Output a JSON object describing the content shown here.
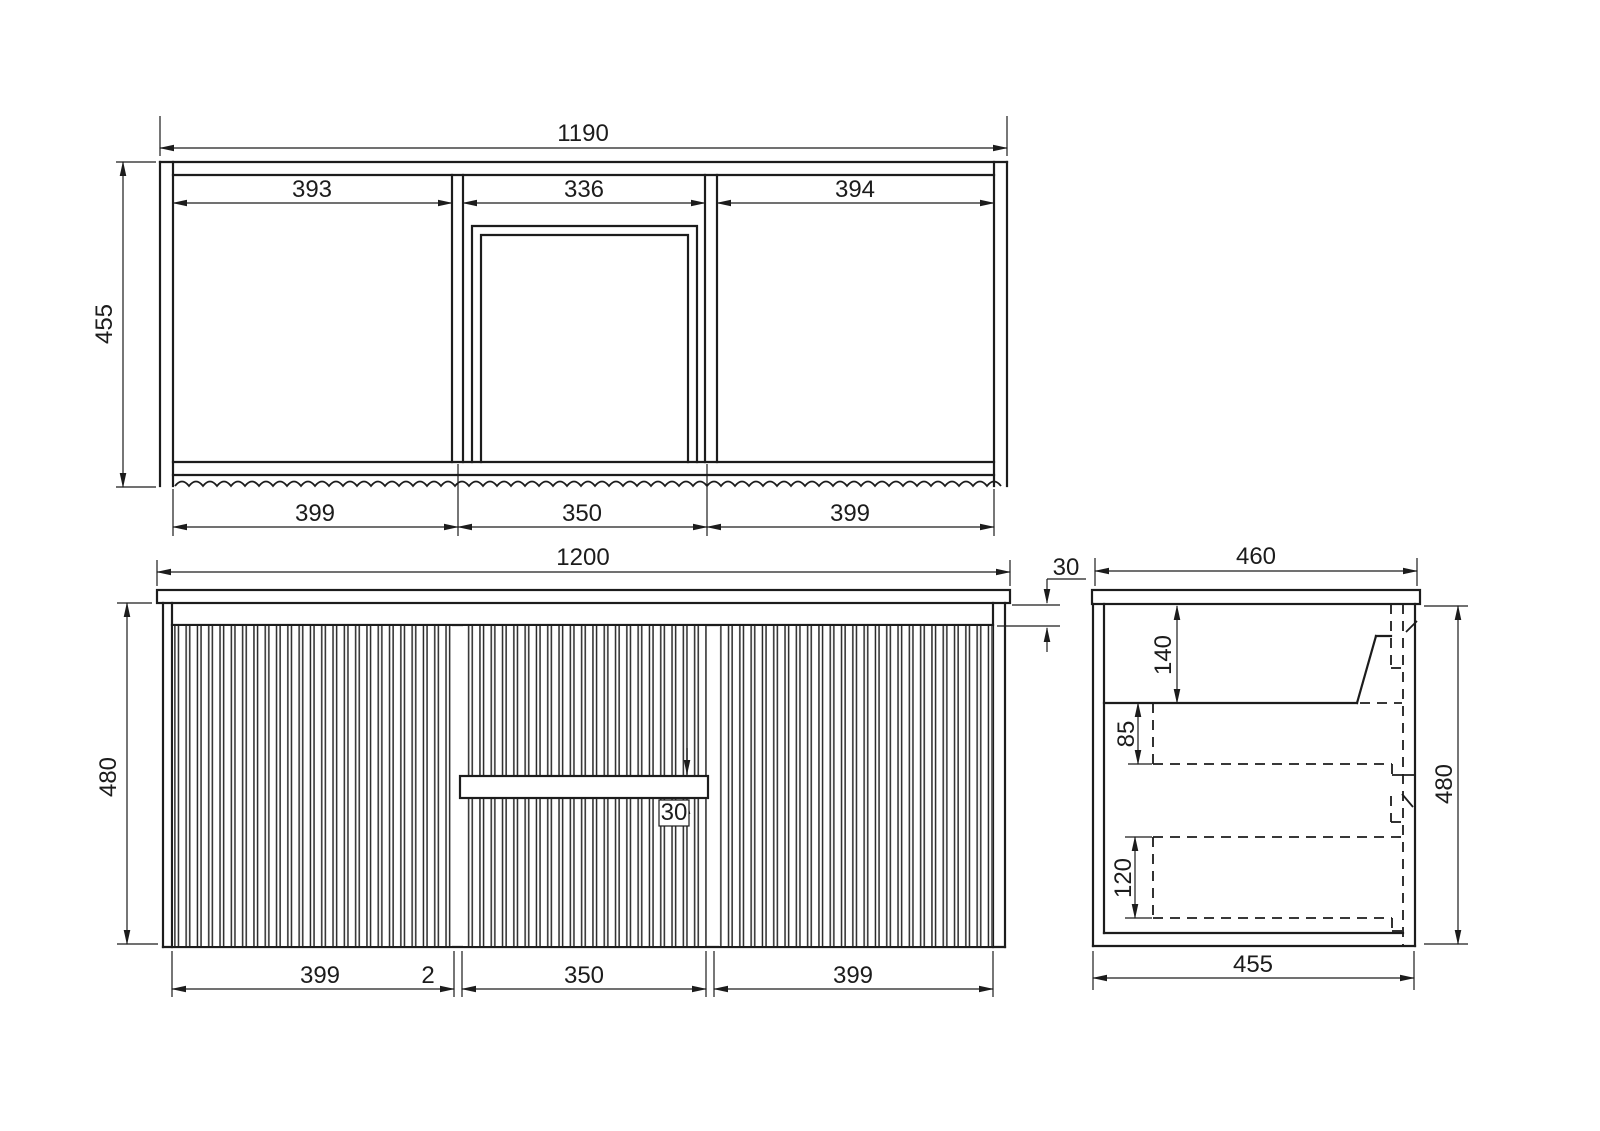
{
  "page": {
    "background": "#ffffff",
    "line_color": "#1c1c1c"
  },
  "views": {
    "top": {
      "overall_width": "1190",
      "overall_depth": "455",
      "opening_widths": [
        "393",
        "336",
        "394"
      ],
      "front_section_widths": [
        "399",
        "350",
        "399"
      ]
    },
    "front": {
      "overall_width": "1200",
      "overall_height": "480",
      "top_reveal": "30",
      "handle_groove_height": "30",
      "door_drawer_widths": [
        "399",
        "2",
        "350",
        "399"
      ]
    },
    "side": {
      "top_depth": "460",
      "overall_height": "480",
      "carcass_depth": "455",
      "basin_zone_height": "140",
      "upper_drawer_height": "85",
      "lower_drawer_height": "120"
    }
  }
}
